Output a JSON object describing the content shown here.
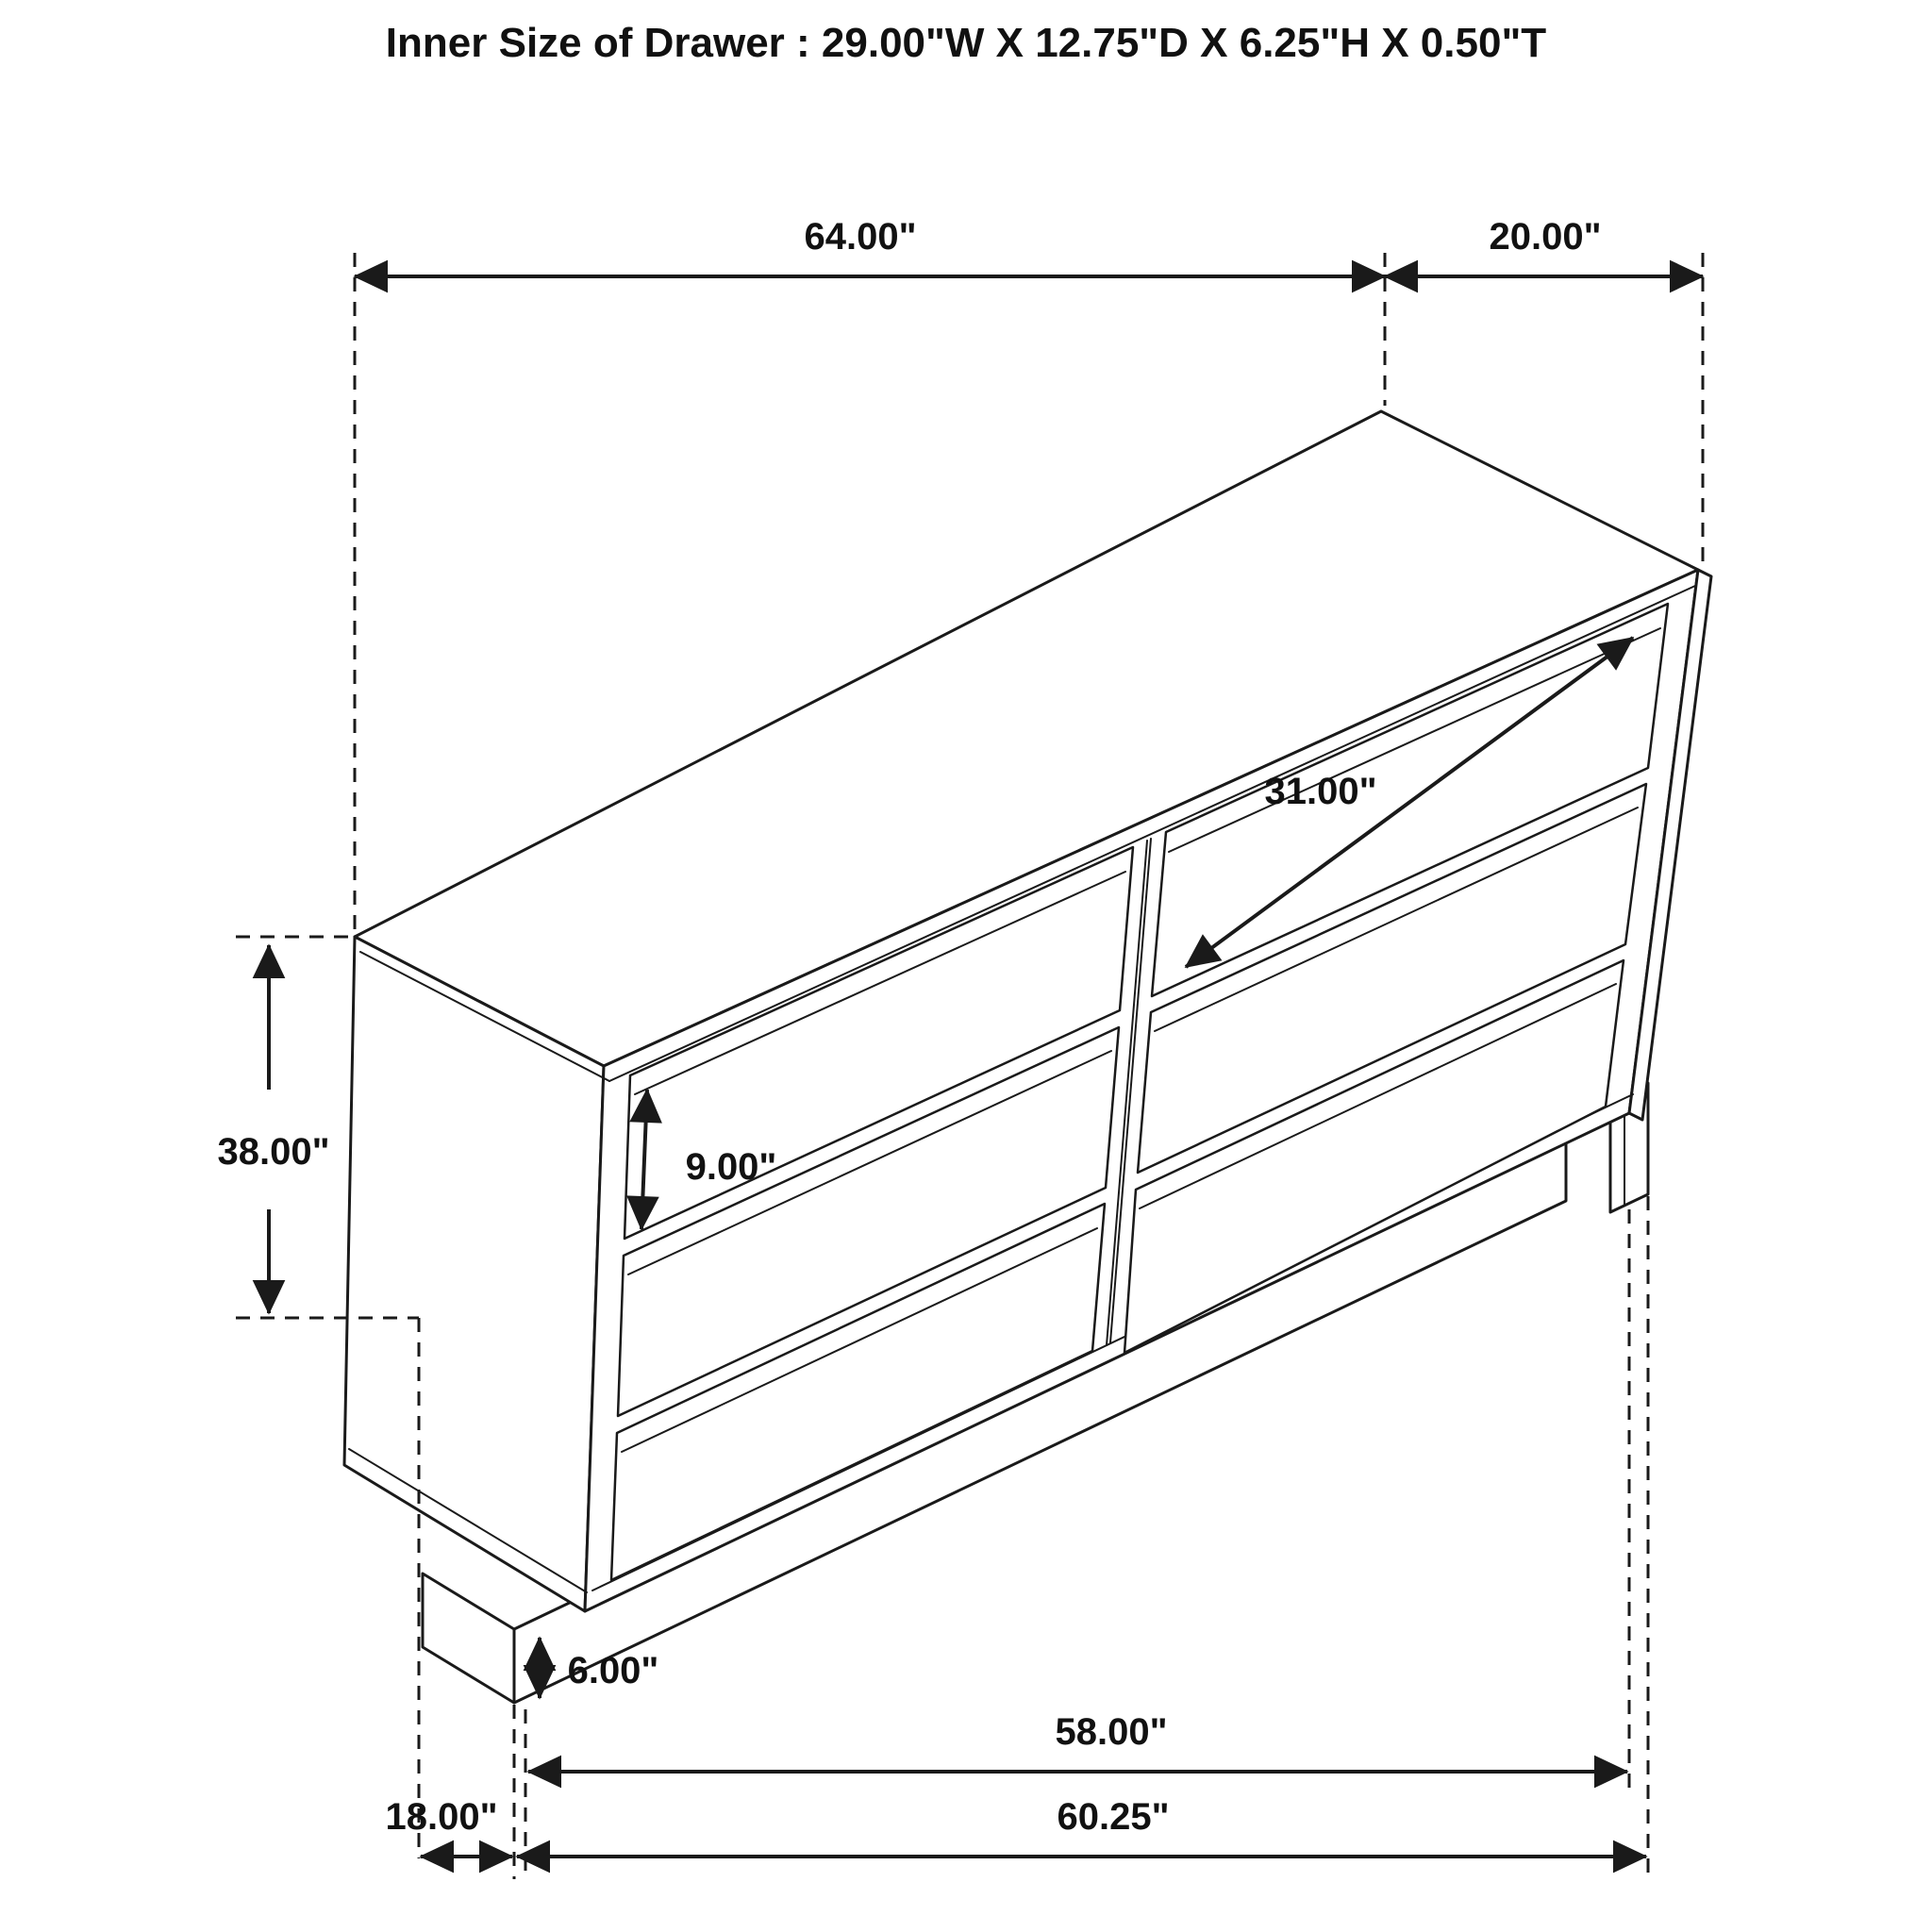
{
  "title": "Inner Size of Drawer : 29.00\"W X 12.75\"D X 6.25\"H X 0.50\"T",
  "subject": "six-drawer dresser isometric dimension drawing",
  "drawer_inner_size": {
    "width": "29.00\"",
    "depth": "12.75\"",
    "height": "6.25\"",
    "thickness": "0.50\""
  },
  "colors": {
    "line": "#1a1a1a",
    "background": "#ffffff"
  },
  "dimensions": {
    "top_width": "64.00\"",
    "top_depth": "20.00\"",
    "drawer_width_diagonal": "31.00\"",
    "drawer_height": "9.00\"",
    "overall_height": "38.00\"",
    "base_height": "6.00\"",
    "bottom_span_inner": "58.00\"",
    "bottom_span_outer": "60.25\"",
    "bottom_left_offset": "18.00\""
  }
}
